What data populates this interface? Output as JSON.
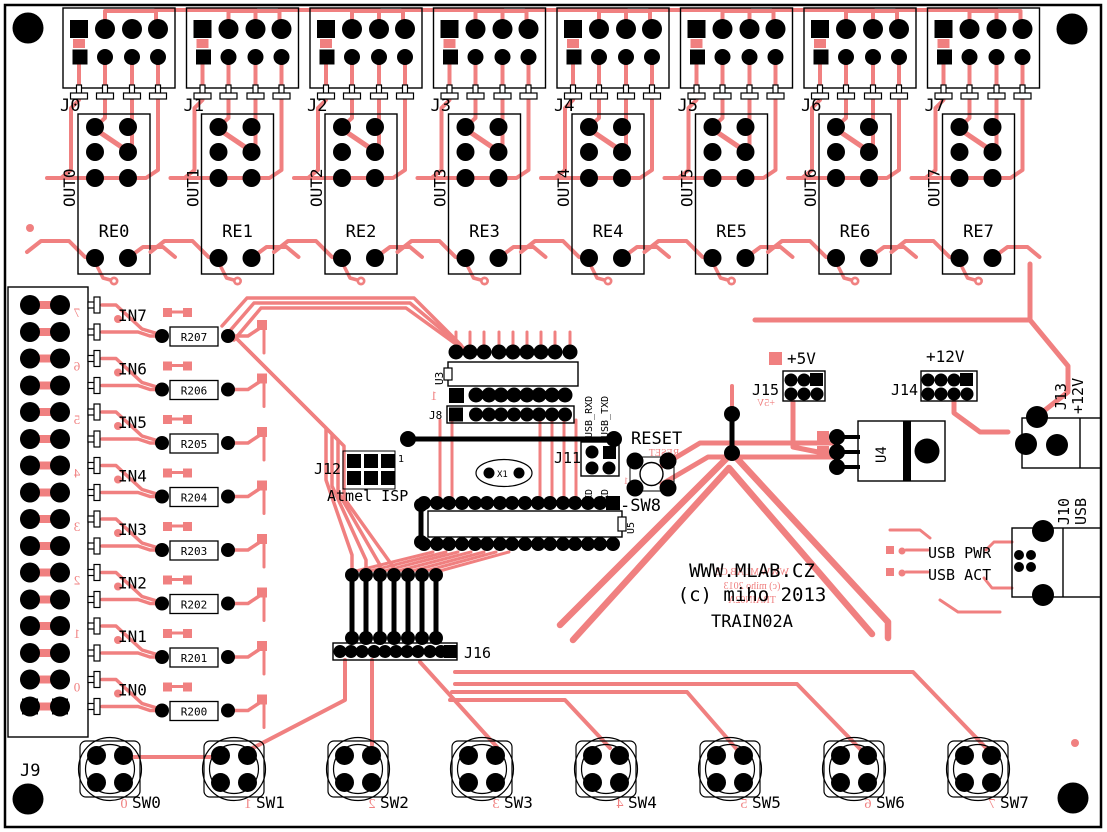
{
  "board": {
    "bg": "#ffffff",
    "trace_color": "#f08080",
    "silk_color": "#000000",
    "brand_line1": "WWW.MLAB.CZ",
    "brand_line2": "(c) miho 2013",
    "brand_line3": "TRAIN02A",
    "brand_mirror1": "WWW.MLAB.CZ",
    "brand_mirror2": "(c) miho 2013",
    "brand_mirror3": "TRAIN02A"
  },
  "channels": [
    {
      "connector": "J0",
      "output": "OUT0",
      "relay": "RE0"
    },
    {
      "connector": "J1",
      "output": "OUT1",
      "relay": "RE1"
    },
    {
      "connector": "J2",
      "output": "OUT2",
      "relay": "RE2"
    },
    {
      "connector": "J3",
      "output": "OUT3",
      "relay": "RE3"
    },
    {
      "connector": "J4",
      "output": "OUT4",
      "relay": "RE4"
    },
    {
      "connector": "J5",
      "output": "OUT5",
      "relay": "RE5"
    },
    {
      "connector": "J6",
      "output": "OUT6",
      "relay": "RE6"
    },
    {
      "connector": "J7",
      "output": "OUT7",
      "relay": "RE7"
    }
  ],
  "inputs": [
    {
      "label": "IN7",
      "resistor": "R207",
      "mirror_digit": "7"
    },
    {
      "label": "IN6",
      "resistor": "R206",
      "mirror_digit": "6"
    },
    {
      "label": "IN5",
      "resistor": "R205",
      "mirror_digit": "5"
    },
    {
      "label": "IN4",
      "resistor": "R204",
      "mirror_digit": "4"
    },
    {
      "label": "IN3",
      "resistor": "R203",
      "mirror_digit": "3"
    },
    {
      "label": "IN2",
      "resistor": "R202",
      "mirror_digit": "2"
    },
    {
      "label": "IN1",
      "resistor": "R201",
      "mirror_digit": "1"
    },
    {
      "label": "IN0",
      "resistor": "R200",
      "mirror_digit": "0"
    }
  ],
  "left_connector": {
    "label": "J9"
  },
  "switches": [
    {
      "label": "SW0",
      "mirror_digit": "0"
    },
    {
      "label": "SW1",
      "mirror_digit": "1"
    },
    {
      "label": "SW2",
      "mirror_digit": "2"
    },
    {
      "label": "SW3",
      "mirror_digit": "3"
    },
    {
      "label": "SW4",
      "mirror_digit": "4"
    },
    {
      "label": "SW5",
      "mirror_digit": "5"
    },
    {
      "label": "SW6",
      "mirror_digit": "6"
    },
    {
      "label": "SW7",
      "mirror_digit": "7"
    }
  ],
  "center": {
    "u3": "U3",
    "u3_pin1": "1",
    "j8": "J8",
    "j12": "J12",
    "j12_pin1": "1",
    "isp": "Atmel ISP",
    "x1": "X1",
    "j11": "J11",
    "usb_rxd": "USB_RXD",
    "usb_txd": "USB_TXD",
    "txd": "TXD",
    "rxd": "RXD",
    "reset": "RESET",
    "reset_mirror": "RESET",
    "sw8": "-SW8",
    "sw8_mirror": "1",
    "u5": "U5",
    "j16": "J16"
  },
  "power": {
    "plus5v": "+5V",
    "plus5v_mirror": "+5V",
    "j15": "J15",
    "plus12v": "+12V",
    "j14": "J14",
    "u4": "U4",
    "j13": "J13",
    "j13_voltage": "+12V",
    "j10": "J10",
    "j10_usb": "USB",
    "usb_pwr": "USB PWR",
    "usb_act": "USB ACT"
  }
}
